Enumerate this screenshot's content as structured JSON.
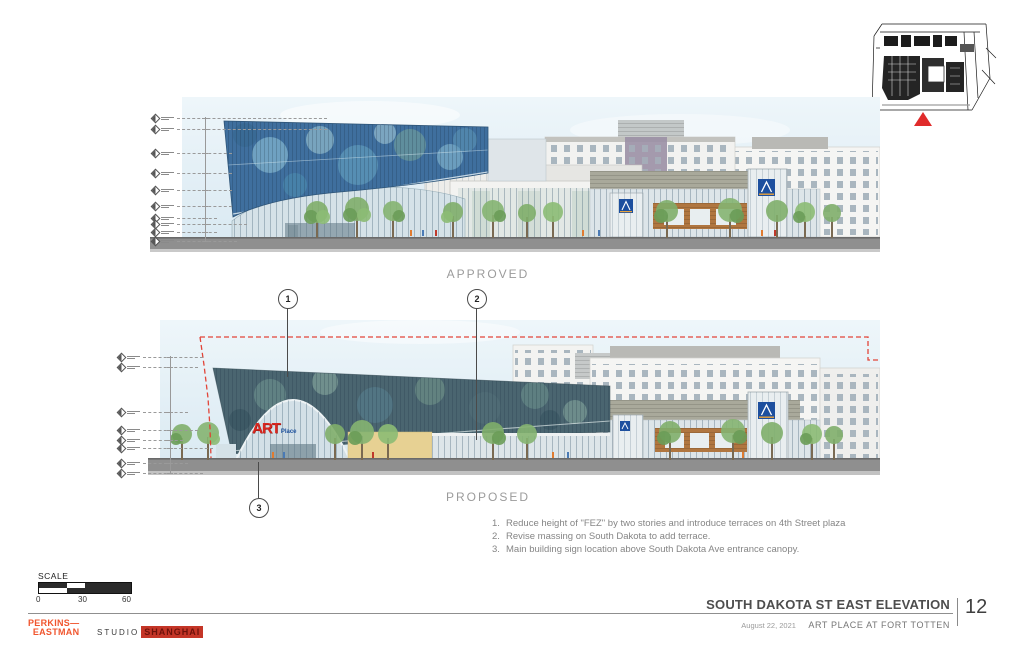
{
  "sheet": {
    "title": "SOUTH DAKOTA ST EAST ELEVATION",
    "page_number": "12",
    "date": "August 22, 2021",
    "project": "ART PLACE AT FORT TOTTEN"
  },
  "drawings": {
    "approved_label": "APPROVED",
    "proposed_label": "PROPOSED"
  },
  "callouts": {
    "c1": "1",
    "c2": "2",
    "c3": "3"
  },
  "notes": [
    {
      "num": "1.",
      "text": "Reduce height of \"FEZ\" by two stories and introduce terraces on 4th Street plaza"
    },
    {
      "num": "2.",
      "text": "Revise massing on South Dakota to add terrace."
    },
    {
      "num": "3.",
      "text": "Main building sign location above South Dakota Ave entrance canopy."
    }
  ],
  "scale_bar": {
    "label": "SCALE",
    "ticks": [
      "0",
      "30",
      "60"
    ]
  },
  "branding": {
    "perkins_line1": "PERKINS—",
    "perkins_line2": "EASTMAN",
    "studio": "STUDIO",
    "shanghai": "SHANGHAI"
  },
  "building_signs": {
    "art": "ART",
    "place": "Place"
  },
  "colors": {
    "callout_red": "#e23b2e",
    "perkins_orange": "#f0552e",
    "shanghai_red": "#c43527",
    "aldi_blue": "#1d4f9e",
    "approved_fez_blue": "#3f6f9e",
    "proposed_fez_teal": "#4a6570",
    "ground_gray": "#8f8f8f"
  }
}
